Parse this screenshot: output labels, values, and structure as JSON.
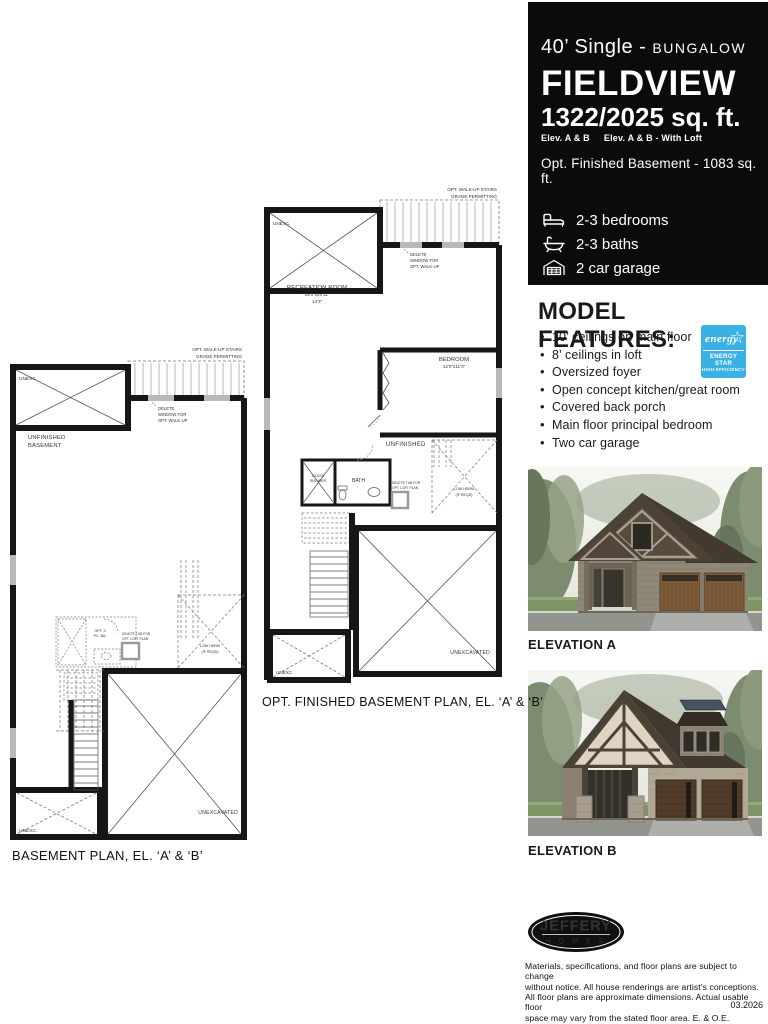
{
  "colors": {
    "header_bg": "#0b0b0b",
    "energy_blue": "#3ab1e4",
    "wall": "#161616"
  },
  "header": {
    "type_main": "40’ Single",
    "type_sep": " - ",
    "type_sub": "BUNGALOW",
    "model_name": "FIELDVIEW",
    "sqft": "1322/2025 sq. ft.",
    "elev_a": "Elev. A & B",
    "elev_b": "Elev. A & B - With Loft",
    "opt_basement": "Opt. Finished Basement - 1083 sq. ft.",
    "stats": [
      {
        "icon": "bed-icon",
        "label": "2-3 bedrooms"
      },
      {
        "icon": "bath-icon",
        "label": "2-3 baths"
      },
      {
        "icon": "garage-icon",
        "label": "2 car garage"
      }
    ]
  },
  "features": {
    "heading": "MODEL FEATURES:",
    "items": [
      "10’ ceilings on main floor",
      "8’ ceilings in loft",
      "Oversized foyer",
      "Open concept kitchen/great room",
      "Covered back porch",
      "Main floor principal bedroom",
      "Two car garage"
    ]
  },
  "energy_star": {
    "script": "energy",
    "star": "☆",
    "line1": "ENERGY STAR",
    "line2": "HIGH EFFICIENCY"
  },
  "elevations": {
    "a_label": "ELEVATION A",
    "b_label": "ELEVATION B"
  },
  "plans": {
    "basement": {
      "caption": "BASEMENT PLAN, EL. ‘A’ & ‘B’",
      "stair_note1": "OPT. WALK-UP STAIRS",
      "stair_note2": "GRADE PERMITTING",
      "unexc_top": "UNEXC.",
      "room1": "UNFINISHED",
      "room2": "BASEMENT",
      "win_note1": "DELETE",
      "win_note2": "WINDOW FOR",
      "win_note3": "OPT. WALK-UP",
      "bath1": "OPT. 3",
      "bath2": "PC. BA.",
      "tub_note1": "DELETE TUB FOR",
      "tub_note2": "OPT. LOFT PLAN",
      "hdrm1": "LOW HDRM",
      "hdrm2": "(IF REQD)",
      "unexcavated": "UNEXCAVATED",
      "unexc_bottom": "UNEXC."
    },
    "opt": {
      "caption": "OPT. FINISHED BASEMENT PLAN, EL. ‘A’ & ‘B’",
      "stair_note1": "OPT. WALK-UP STAIRS",
      "stair_note2": "GRADE PERMITTING",
      "unexc_top": "UNEXC.",
      "rec1": "RECREATION ROOM",
      "rec2": "25’0”x24’11”",
      "rec3": "14’3”",
      "win_note1": "DELETE",
      "win_note2": "WINDOW FOR",
      "win_note3": "OPT. WALK-UP",
      "bedroom1": "BEDROOM",
      "bedroom2": "12’0”x11’0”",
      "unfinished": "UNFINISHED",
      "shower1": "GLASS",
      "shower2": "SHOWER",
      "bath": "BATH",
      "tub_note1": "DELETE TUB FOR",
      "tub_note2": "OPT. LOFT PLAN",
      "hdrm1": "LOW HDRM",
      "hdrm2": "(IF REQD)",
      "unexcavated": "UNEXCAVATED",
      "unexc_bottom": "UNEXC."
    }
  },
  "logo": {
    "name": "JEFFERY",
    "homes": "H   O   M   E   S"
  },
  "footer": {
    "disclaimer": "Materials, specifications, and floor plans are subject to change\nwithout notice. All house renderings are artist’s conceptions.\nAll floor plans are approximate dimensions. Actual usable floor\nspace may vary from the stated floor area. E. & O.E.",
    "date": "03.2026"
  }
}
